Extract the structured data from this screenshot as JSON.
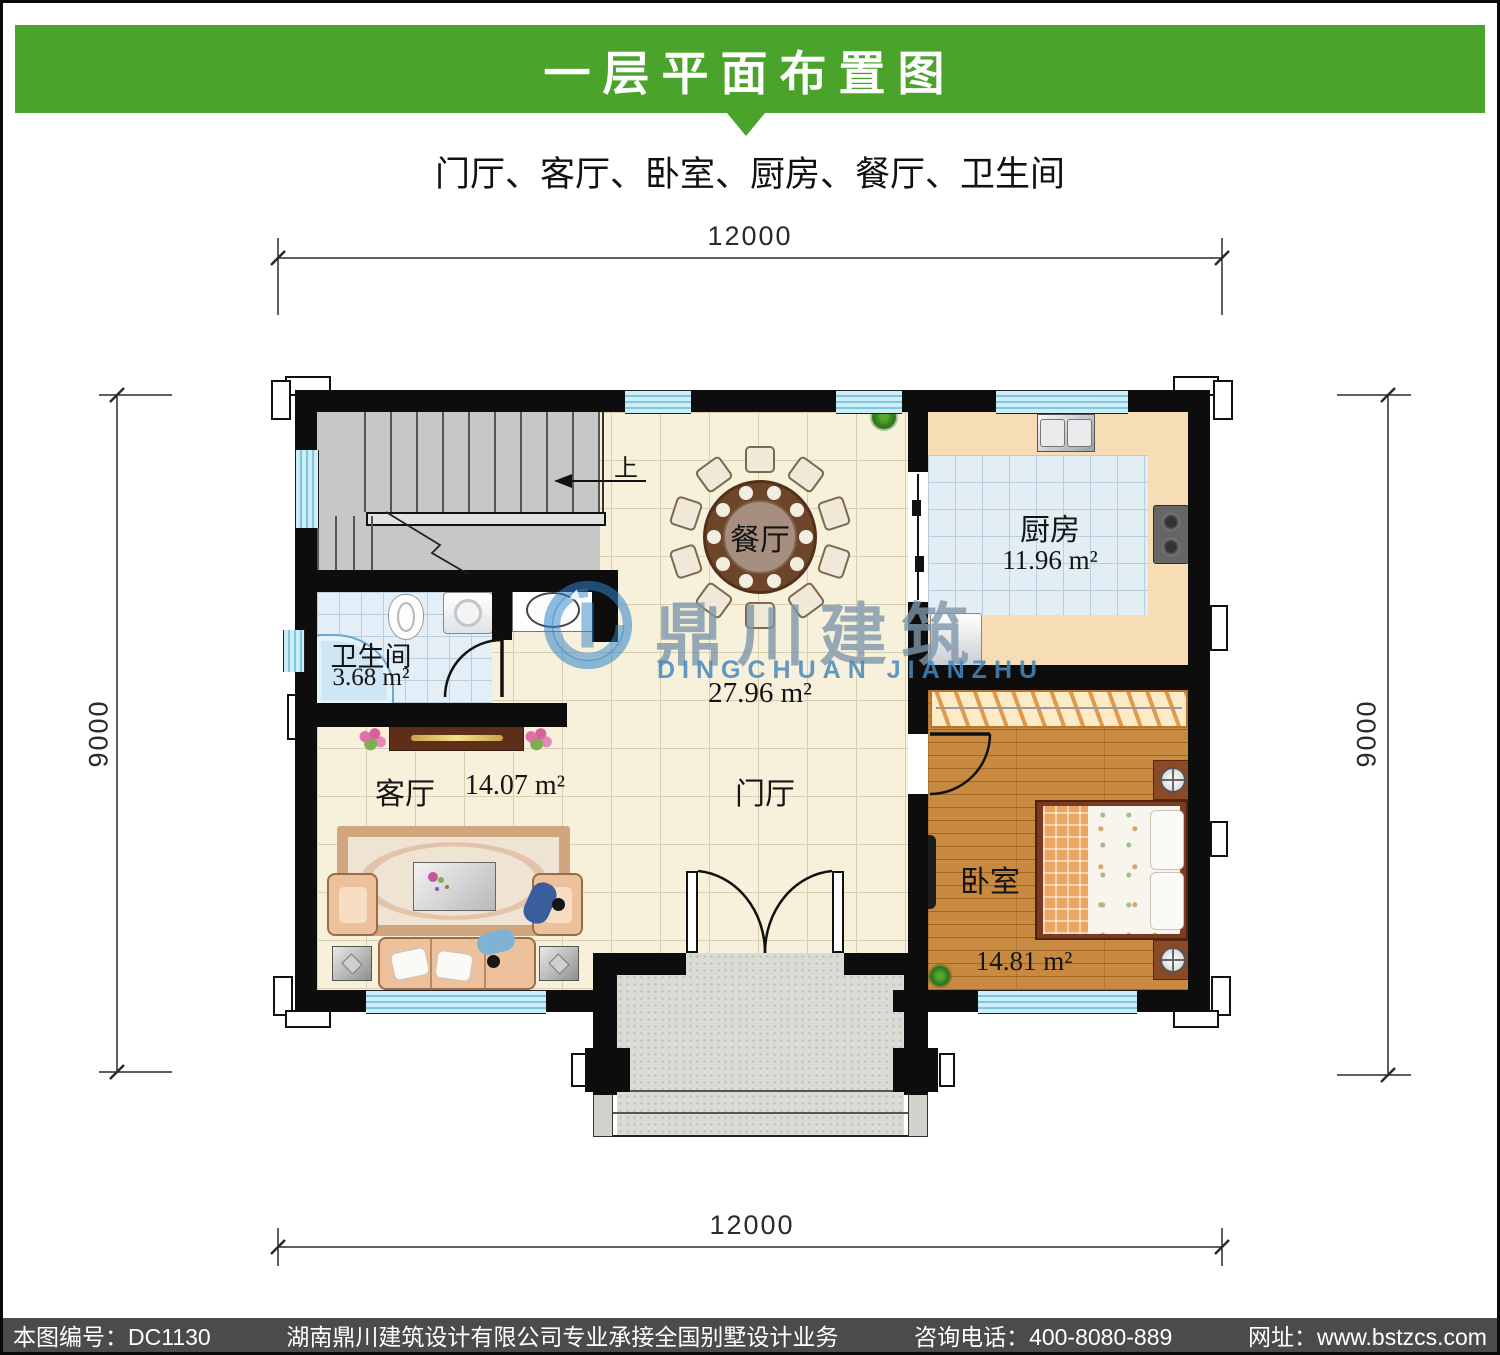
{
  "header": {
    "title": "一层平面布置图",
    "subtitle": "门厅、客厅、卧室、厨房、餐厅、卫生间"
  },
  "dimensions": {
    "top": "12000",
    "bottom": "12000",
    "left": "9000",
    "right": "9000"
  },
  "rooms": {
    "dining_label": "餐厅",
    "hall_label": "门厅",
    "hall_area": "27.96 m²",
    "kitchen_label": "厨房",
    "kitchen_area": "11.96 m²",
    "bath_label": "卫生间",
    "bath_area": "3.68 m²",
    "living_label": "客厅",
    "living_area": "14.07 m²",
    "bedroom_label": "卧室",
    "bedroom_area": "14.81 m²",
    "stairs_up": "上"
  },
  "watermark": {
    "cn": "鼎川建筑",
    "en": "DINGCHUAN JIANZHU"
  },
  "footer": {
    "drawing_no": "本图编号：DC1130",
    "company": "湖南鼎川建筑设计有限公司专业承接全国别墅设计业务",
    "phone": "咨询电话：400-8080-889",
    "website": "网址：www.bstzcs.com"
  },
  "colors": {
    "banner_green": "#4aa32a",
    "footer_gray": "#4b4b4b",
    "wall_black": "#0d0d0d",
    "window_blue": "#cdeef9",
    "floor_cream": "#f7f1db",
    "tile_blue": "#e3edf4",
    "wood_orange": "#c88a40",
    "watermark_blue": "#2f84c8"
  }
}
